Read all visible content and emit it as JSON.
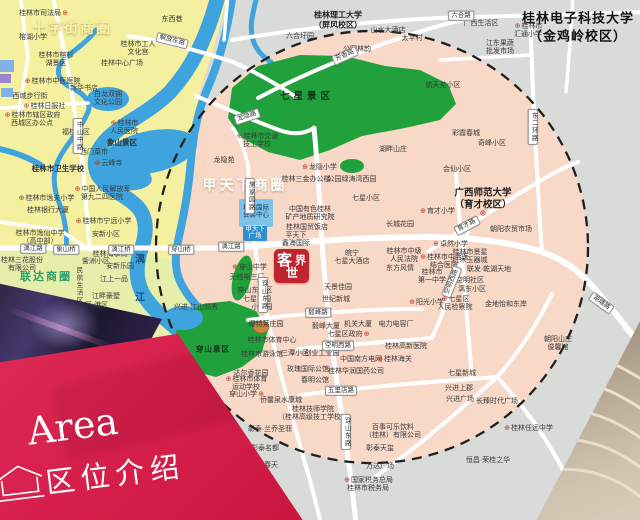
{
  "banner": {
    "en": "Area",
    "zh": "区位介绍"
  },
  "logo": {
    "c1": "客",
    "c2": "世",
    "c3": "界"
  },
  "colors": {
    "circle_fill": "#f8d8c6",
    "district_yellow": "#f5f0a0",
    "district_yellow_green": "#e6eeac",
    "park_green": "#21a13c",
    "river_blue": "#3fa4de",
    "road_white": "#ffffff",
    "outside_gray": "#d9dbd8",
    "banner_red": "#d6204b",
    "logo_red": "#c0242f",
    "marker_red": "#c0392b"
  },
  "map": {
    "labels": [
      {
        "t": "十字街商圈",
        "x": 72,
        "y": 28,
        "k": "a1",
        "n": "district-label-shizijie"
      },
      {
        "t": "甲天下商圈",
        "x": 245,
        "y": 185,
        "k": "a2",
        "n": "district-label-jiatianxia"
      },
      {
        "t": "联达商圈",
        "x": 46,
        "y": 276,
        "k": "a3",
        "n": "district-label-lianda"
      },
      {
        "t": "七星景区",
        "x": 307,
        "y": 95,
        "k": "g",
        "n": "park-label-qixing"
      },
      {
        "t": "穿山景区",
        "x": 213,
        "y": 349,
        "k": "g2",
        "n": "park-label-chuanshan"
      },
      {
        "t": "桂林电子科技大学|（金鸡岭校区）",
        "x": 578,
        "y": 27,
        "k": "u1",
        "n": "university-guet"
      },
      {
        "t": "桂林理工大学|（屏风校区）",
        "x": 338,
        "y": 21,
        "k": "u2",
        "n": "university-glut"
      },
      {
        "t": "广西师范大学|（育才校区）",
        "x": 483,
        "y": 200,
        "k": "u3",
        "n": "university-gxnu"
      },
      {
        "t": "⊕",
        "x": 483,
        "y": 213,
        "k": "mkk",
        "n": "poi-marker-icon"
      },
      {
        "t": "漓",
        "x": 140,
        "y": 258,
        "k": "w",
        "n": "river-label-li"
      },
      {
        "t": "江",
        "x": 140,
        "y": 296,
        "k": "w",
        "n": "river-label-jiang"
      },
      {
        "t": "桂林市司法局",
        "x": 44,
        "y": 14,
        "k": "p",
        "m": "r"
      },
      {
        "t": "东西巷",
        "x": 172,
        "y": 20,
        "k": "p"
      },
      {
        "t": "桂林市工人|文化宫",
        "x": 138,
        "y": 49,
        "k": "p"
      },
      {
        "t": "桂林中心广场",
        "x": 122,
        "y": 64,
        "k": "p"
      },
      {
        "t": "榕湖小学",
        "x": 33,
        "y": 38,
        "k": "p"
      },
      {
        "t": "桂林市榕杉|湖景区",
        "x": 56,
        "y": 60,
        "k": "p"
      },
      {
        "t": "桂林市中医医院",
        "x": 52,
        "y": 82,
        "k": "p",
        "m": "l"
      },
      {
        "t": "新华书店",
        "x": 84,
        "y": 89,
        "k": "p"
      },
      {
        "t": "西城步行街",
        "x": 30,
        "y": 97,
        "k": "p"
      },
      {
        "t": "桂林日报社",
        "x": 44,
        "y": 107,
        "k": "p",
        "m": "l"
      },
      {
        "t": "白龙双拥|文化公园",
        "x": 108,
        "y": 99,
        "k": "p"
      },
      {
        "t": "桂林市辖区政府|西城区办公点",
        "x": 32,
        "y": 120,
        "k": "p",
        "m": "l"
      },
      {
        "t": "福桂小区",
        "x": 76,
        "y": 133,
        "k": "p"
      },
      {
        "t": "桂林市|人民医院",
        "x": 124,
        "y": 128,
        "k": "p",
        "m": "l"
      },
      {
        "t": "象山景区",
        "x": 122,
        "y": 143,
        "k": "p8"
      },
      {
        "t": "西门菜市",
        "x": 94,
        "y": 153,
        "k": "p"
      },
      {
        "t": "云峰寺",
        "x": 108,
        "y": 164,
        "k": "p",
        "m": "l"
      },
      {
        "t": "桂林市卫生学校",
        "x": 58,
        "y": 169,
        "k": "p8"
      },
      {
        "t": "桂林市逸夫小学",
        "x": 46,
        "y": 199,
        "k": "p",
        "m": "l"
      },
      {
        "t": "桂林银行大厦",
        "x": 48,
        "y": 211,
        "k": "p"
      },
      {
        "t": "桂林市逸仙中学|（高中部）",
        "x": 40,
        "y": 238,
        "k": "p"
      },
      {
        "t": "中国人民解放军|第九二四医院",
        "x": 102,
        "y": 194,
        "k": "p",
        "m": "l"
      },
      {
        "t": "桂林市宁远小学",
        "x": 103,
        "y": 222,
        "k": "p",
        "m": "l"
      },
      {
        "t": "安新小区",
        "x": 106,
        "y": 235,
        "k": "p"
      },
      {
        "t": "訾洲小区",
        "x": 96,
        "y": 262,
        "k": "p"
      },
      {
        "t": "安新乐园",
        "x": 120,
        "y": 267,
        "k": "p"
      },
      {
        "t": "江上一品",
        "x": 114,
        "y": 280,
        "k": "p"
      },
      {
        "t": "江畔豪墅",
        "x": 106,
        "y": 297,
        "k": "p"
      },
      {
        "t": "安新小区-港区",
        "x": 86,
        "y": 306,
        "k": "p"
      },
      {
        "t": "桂林三花股份|有限公司",
        "x": 22,
        "y": 265,
        "k": "p"
      },
      {
        "t": "桂林海事局",
        "x": 110,
        "y": 255,
        "k": "p"
      },
      {
        "t": "民航生活区",
        "x": 78,
        "y": 285,
        "k": "pv"
      },
      {
        "t": "桂林国际|会展中心",
        "x": 256,
        "y": 212,
        "k": "bb"
      },
      {
        "t": "甲天下|广场",
        "x": 255,
        "y": 233,
        "k": "bw"
      },
      {
        "t": "桂林市交通|技工学校",
        "x": 257,
        "y": 141,
        "k": "p",
        "m": "l"
      },
      {
        "t": "龙隐苑",
        "x": 224,
        "y": 161,
        "k": "p"
      },
      {
        "t": "龙隐小学",
        "x": 319,
        "y": 168,
        "k": "p",
        "m": "l"
      },
      {
        "t": "桂林三金办公楼",
        "x": 306,
        "y": 180,
        "k": "p"
      },
      {
        "t": "公园绿涛湾西园",
        "x": 352,
        "y": 180,
        "k": "p"
      },
      {
        "t": "会仙小区",
        "x": 457,
        "y": 170,
        "k": "p"
      },
      {
        "t": "七星小区",
        "x": 366,
        "y": 199,
        "k": "p"
      },
      {
        "t": "育才小学",
        "x": 437,
        "y": 212,
        "k": "p",
        "m": "l"
      },
      {
        "t": "长城花园",
        "x": 400,
        "y": 225,
        "k": "p"
      },
      {
        "t": "中国有色桂林|矿产地质研究院",
        "x": 310,
        "y": 214,
        "k": "p"
      },
      {
        "t": "桂林国贸饭店",
        "x": 307,
        "y": 228,
        "k": "p"
      },
      {
        "t": "平天下|鑫海国际",
        "x": 296,
        "y": 240,
        "k": "p"
      },
      {
        "t": "皖宁|七星大酒店",
        "x": 352,
        "y": 258,
        "k": "p"
      },
      {
        "t": "桂林市中级|人民法院",
        "x": 404,
        "y": 256,
        "k": "p"
      },
      {
        "t": "东方风情",
        "x": 400,
        "y": 269,
        "k": "p"
      },
      {
        "t": "桂林市|第一中学",
        "x": 432,
        "y": 277,
        "k": "p"
      },
      {
        "t": "天景佳园",
        "x": 338,
        "y": 288,
        "k": "p"
      },
      {
        "t": "世纪新城",
        "x": 336,
        "y": 300,
        "k": "p"
      },
      {
        "t": "穿山中学",
        "x": 249,
        "y": 268,
        "k": "p",
        "m": "l"
      },
      {
        "t": "无线电三厂",
        "x": 247,
        "y": 278,
        "k": "p"
      },
      {
        "t": "穿山东社区",
        "x": 255,
        "y": 291,
        "k": "p"
      },
      {
        "t": "七星花园",
        "x": 257,
        "y": 300,
        "k": "p"
      },
      {
        "t": "小港园",
        "x": 262,
        "y": 308,
        "k": "p"
      },
      {
        "t": "樱特莱庄园",
        "x": 266,
        "y": 325,
        "k": "p"
      },
      {
        "t": "桂林市体育中心",
        "x": 272,
        "y": 341,
        "k": "p"
      },
      {
        "t": "毅峰大厦",
        "x": 326,
        "y": 327,
        "k": "p"
      },
      {
        "t": "机关大厦",
        "x": 358,
        "y": 325,
        "k": "p"
      },
      {
        "t": "电力电容厂",
        "x": 396,
        "y": 325,
        "k": "p"
      },
      {
        "t": "阳光小学",
        "x": 426,
        "y": 303,
        "k": "p",
        "m": "l"
      },
      {
        "t": "桂林市景星|红木玉器城",
        "x": 470,
        "y": 257,
        "k": "p"
      },
      {
        "t": "湖畔山庄",
        "x": 393,
        "y": 150,
        "k": "p"
      },
      {
        "t": "航天苑小区",
        "x": 443,
        "y": 86,
        "k": "p"
      },
      {
        "t": "太平村",
        "x": 412,
        "y": 39,
        "k": "p"
      },
      {
        "t": "山水大酒店",
        "x": 388,
        "y": 31,
        "k": "p"
      },
      {
        "t": "公园林韵",
        "x": 357,
        "y": 50,
        "k": "p"
      },
      {
        "t": "六合圩园",
        "x": 300,
        "y": 37,
        "k": "p"
      },
      {
        "t": "桂林市|汇通小学",
        "x": 528,
        "y": 31,
        "k": "p",
        "m": "l"
      },
      {
        "t": "江东果蔬|批发市场",
        "x": 500,
        "y": 48,
        "k": "p"
      },
      {
        "t": "广西生活区",
        "x": 481,
        "y": 24,
        "k": "p"
      },
      {
        "t": "彩霞春城",
        "x": 466,
        "y": 134,
        "k": "p"
      },
      {
        "t": "奇峰小区",
        "x": 492,
        "y": 144,
        "k": "p"
      },
      {
        "t": "朝阳农贸市场",
        "x": 511,
        "y": 230,
        "k": "p"
      },
      {
        "t": "卓然小学",
        "x": 450,
        "y": 245,
        "k": "p",
        "m": "l"
      },
      {
        "t": "桂林市中西医|结合医院",
        "x": 444,
        "y": 262,
        "k": "p",
        "m": "l"
      },
      {
        "t": "空明社区",
        "x": 470,
        "y": 281,
        "k": "p"
      },
      {
        "t": "漓东小区",
        "x": 472,
        "y": 290,
        "k": "p"
      },
      {
        "t": "七星区|人民检察院",
        "x": 455,
        "y": 304,
        "k": "p",
        "m": "l"
      },
      {
        "t": "联发·乾湖天地",
        "x": 489,
        "y": 270,
        "k": "p"
      },
      {
        "t": "金地怡和东岸",
        "x": 506,
        "y": 305,
        "k": "p"
      },
      {
        "t": "七星区政府",
        "x": 349,
        "y": 335,
        "k": "p",
        "m": "r"
      },
      {
        "t": "桂林高新医院",
        "x": 406,
        "y": 347,
        "k": "p"
      },
      {
        "t": "桂林市游泳馆",
        "x": 262,
        "y": 355,
        "k": "p"
      },
      {
        "t": "三潭小区",
        "x": 295,
        "y": 354,
        "k": "p"
      },
      {
        "t": "创业工业园",
        "x": 322,
        "y": 354,
        "k": "p"
      },
      {
        "t": "达尔香花园",
        "x": 251,
        "y": 374,
        "k": "p"
      },
      {
        "t": "桂林市体育|运动学校",
        "x": 246,
        "y": 384,
        "k": "p",
        "m": "l"
      },
      {
        "t": "穿山小学",
        "x": 247,
        "y": 395,
        "k": "p",
        "m": "r"
      },
      {
        "t": "侨馨泉水康城",
        "x": 281,
        "y": 401,
        "k": "p"
      },
      {
        "t": "玫瑰国际公馆",
        "x": 308,
        "y": 370,
        "k": "p"
      },
      {
        "t": "春明公馆",
        "x": 315,
        "y": 381,
        "k": "p"
      },
      {
        "t": "中国南方电网",
        "x": 361,
        "y": 360,
        "k": "p"
      },
      {
        "t": "桂林海关",
        "x": 394,
        "y": 360,
        "k": "p",
        "m": "l"
      },
      {
        "t": "桂林华润国药公司",
        "x": 356,
        "y": 372,
        "k": "p"
      },
      {
        "t": "桂林技师学院|（桂林高级技工学校）",
        "x": 313,
        "y": 414,
        "k": "p"
      },
      {
        "t": "百事可乐饮料|（桂林）有限公司",
        "x": 393,
        "y": 432,
        "k": "p"
      },
      {
        "t": "彰泰·兰乔圣菲",
        "x": 270,
        "y": 430,
        "k": "p"
      },
      {
        "t": "彰泰名都",
        "x": 265,
        "y": 449,
        "k": "p"
      },
      {
        "t": "彰泰春天",
        "x": 264,
        "y": 466,
        "k": "p"
      },
      {
        "t": "彰泰天玺",
        "x": 380,
        "y": 449,
        "k": "p"
      },
      {
        "t": "万达广场",
        "x": 380,
        "y": 467,
        "k": "p"
      },
      {
        "t": "国家税务总局|桂林市税务局",
        "x": 368,
        "y": 485,
        "k": "p",
        "m": "l"
      },
      {
        "t": "七星新城",
        "x": 462,
        "y": 374,
        "k": "p"
      },
      {
        "t": "兴进上郡",
        "x": 459,
        "y": 389,
        "k": "p"
      },
      {
        "t": "兴进广场",
        "x": 460,
        "y": 400,
        "k": "p"
      },
      {
        "t": "长臻时代广场",
        "x": 497,
        "y": 402,
        "k": "p"
      },
      {
        "t": "朝阳山庄|俊馨馆",
        "x": 558,
        "y": 344,
        "k": "p"
      },
      {
        "t": "桂林任远中学",
        "x": 528,
        "y": 429,
        "k": "p",
        "m": "l"
      },
      {
        "t": "恒昌·荣桂之华",
        "x": 488,
        "y": 461,
        "k": "p"
      },
      {
        "t": "兴进·江山领秀",
        "x": 196,
        "y": 308,
        "k": "p"
      },
      {
        "t": "解放东路",
        "x": 172,
        "y": 41,
        "k": "r",
        "r": 14,
        "n": "road-label"
      },
      {
        "t": "中山中路",
        "x": 78,
        "y": 136,
        "k": "rv",
        "n": "road-label"
      },
      {
        "t": "漓江路",
        "x": 33,
        "y": 249,
        "k": "r",
        "n": "road-label"
      },
      {
        "t": "象山桥",
        "x": 66,
        "y": 250,
        "k": "r",
        "n": "bridge-label"
      },
      {
        "t": "漓江桥",
        "x": 121,
        "y": 250,
        "k": "r",
        "n": "bridge-label"
      },
      {
        "t": "穿山桥",
        "x": 181,
        "y": 250,
        "k": "r",
        "n": "bridge-label"
      },
      {
        "t": "漓江路",
        "x": 231,
        "y": 247,
        "k": "r",
        "n": "road-label"
      },
      {
        "t": "龙隐路",
        "x": 247,
        "y": 117,
        "k": "r",
        "r": -18,
        "n": "road-label"
      },
      {
        "t": "芳香路",
        "x": 345,
        "y": 56,
        "k": "r",
        "r": -24,
        "n": "road-label"
      },
      {
        "t": "六合路",
        "x": 461,
        "y": 16,
        "k": "r",
        "n": "road-label"
      },
      {
        "t": "东二环路",
        "x": 533,
        "y": 127,
        "k": "rv",
        "n": "road-label"
      },
      {
        "t": "施家园路",
        "x": 250,
        "y": 196,
        "k": "rv",
        "n": "road-label"
      },
      {
        "t": "毅峰路",
        "x": 318,
        "y": 313,
        "k": "r",
        "n": "road-label"
      },
      {
        "t": "空明西路",
        "x": 338,
        "y": 346,
        "k": "r",
        "n": "road-label"
      },
      {
        "t": "空明西路",
        "x": 452,
        "y": 282,
        "k": "r",
        "r": -68,
        "n": "road-label"
      },
      {
        "t": "五里店路",
        "x": 341,
        "y": 391,
        "k": "r",
        "n": "road-label"
      },
      {
        "t": "育才路",
        "x": 467,
        "y": 226,
        "k": "r",
        "r": -28,
        "n": "road-label"
      },
      {
        "t": "湖塘路",
        "x": 601,
        "y": 303,
        "k": "r",
        "r": 36,
        "n": "road-label"
      },
      {
        "t": "穿山东路",
        "x": 263,
        "y": 295,
        "k": "rv",
        "n": "road-label"
      },
      {
        "t": "穿山东路",
        "x": 346,
        "y": 432,
        "k": "rv",
        "n": "road-label"
      }
    ]
  }
}
